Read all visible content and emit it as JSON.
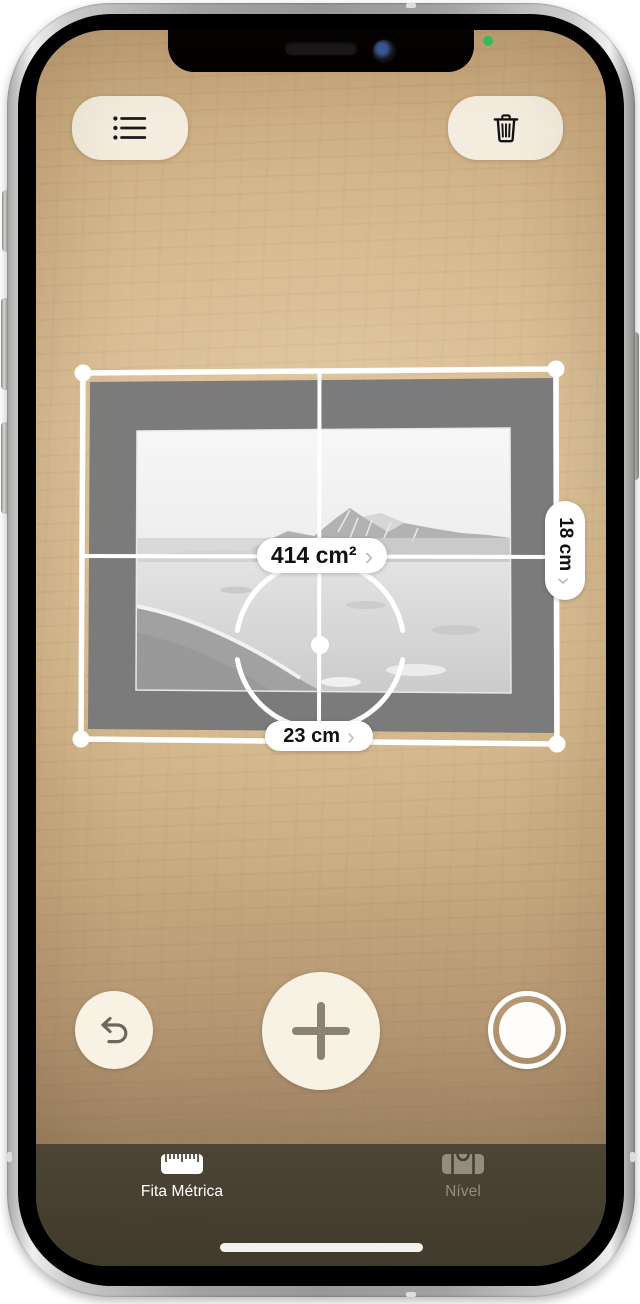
{
  "screen": {
    "toolbar": {
      "list_button": {
        "icon": "bullet-list-icon"
      },
      "trash_button": {
        "icon": "trash-icon"
      }
    },
    "measurement": {
      "area": {
        "label": "414 cm²",
        "chevron": "›"
      },
      "width": {
        "label": "23 cm",
        "chevron": "›"
      },
      "height": {
        "label": "18 cm",
        "chevron": "›"
      }
    },
    "controls": {
      "undo": {
        "icon": "undo-arrow-icon"
      },
      "add": {
        "icon": "plus-icon"
      },
      "shutter": {
        "icon": "shutter-icon"
      }
    },
    "tab_bar": {
      "tabs": [
        {
          "label": "Fita Métrica",
          "icon": "ruler-icon",
          "active": true
        },
        {
          "label": "Nível",
          "icon": "level-icon",
          "active": false
        }
      ]
    }
  },
  "colors": {
    "button_cream": "#f3ecdf",
    "overlay_white": "#ffffff",
    "wood_tan": "#d2b286",
    "frame_mat_gray": "#7b7b7b",
    "tab_bar_bg": "#474031",
    "tab_active_text": "#ffffff",
    "tab_inactive_text": "#948d7b",
    "indicator_green": "#34c759",
    "pill_text": "#111111",
    "chevron_gray": "#bcbcbc"
  }
}
